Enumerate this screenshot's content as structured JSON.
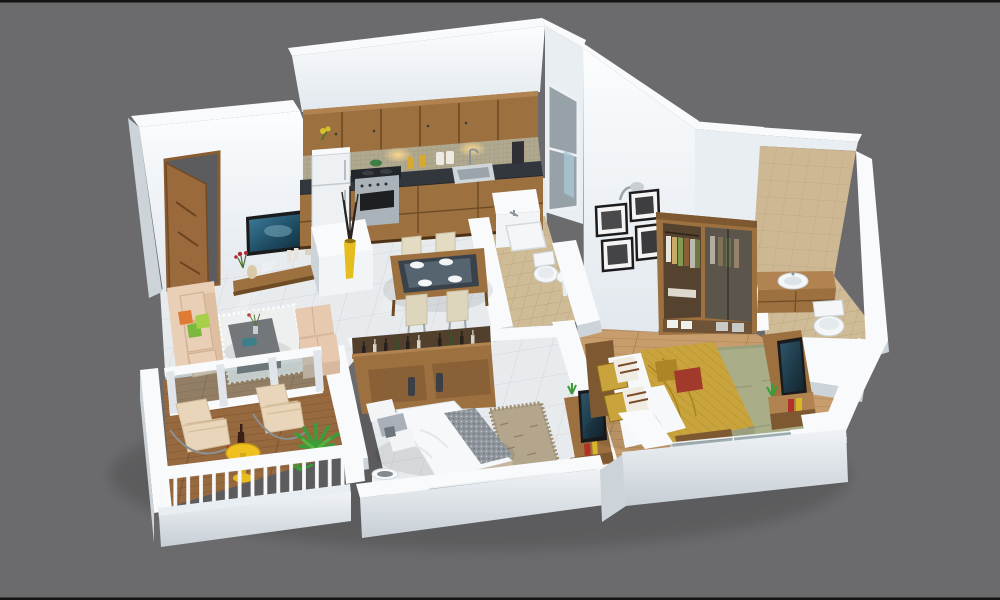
{
  "meta": {
    "description": "3D isometric render of a 2BHK apartment floor plan viewed from above on a plain gray background; no text labels are visible in the image",
    "image_type": "architectural-3d-floorplan"
  },
  "palette": {
    "bg": "#6b6b6d",
    "wallTop": "#f8fafc",
    "wallFace": "#e9eef2",
    "wallShade": "#ccd4da",
    "tileFloor": "#e8ebee",
    "tileLine": "#d0d5d9",
    "woodFloor": "#c79d6d",
    "woodLine": "#b08455",
    "deck": "#96693f",
    "deckLine": "#7a5230",
    "bathTile": "#cfbb95",
    "bathLine": "#b7a47e",
    "cabinet": "#9d7040",
    "cabinetDark": "#7e5830",
    "cabinetLight": "#b08350",
    "counter": "#32373d",
    "mosaic": "#b0a98f",
    "steel": "#aab3b9",
    "fridge": "#eef1f3",
    "door": "#9a6a3c",
    "tv": "#1a1b1d",
    "tvScreen": "#2e6f8f",
    "sofa": "#dfbfa2",
    "sofaLight": "#e9cfb5",
    "pillowOrange": "#e07b35",
    "pillowGreen": "#7cb83f",
    "pillowLime": "#a8cf4a",
    "coffeeTable": "#74777a",
    "rugWhite": "#eff1f1",
    "ottoman": "#e6c9ae",
    "vaseYellow": "#e6bd1f",
    "glass": "#9fb4bc",
    "bedWhite": "#f6f8f9",
    "bedGray": "#8f959c",
    "bedGold": "#c9a33c",
    "bedGoldDark": "#ab8526",
    "pillowRed": "#a23a2c",
    "rugSage": "#a9ad88",
    "rugShag": "#b3a68c",
    "plant": "#3c9c38",
    "toilet": "#f4f6f8",
    "tileWall": "#cdb893"
  },
  "rooms": [
    {
      "name": "living-room",
      "furniture": [
        "entrance-door",
        "wall-mounted-tv",
        "tv-shelf",
        "sofa",
        "cushions",
        "coffee-table",
        "white-rug",
        "ottoman-poufs",
        "yellow-floor-vase"
      ]
    },
    {
      "name": "kitchen",
      "furniture": [
        "upper-cabinets",
        "under-cabinet-lights",
        "mosaic-backsplash",
        "dark-countertop",
        "stove-oven",
        "sink",
        "refrigerator",
        "base-cabinets",
        "white-counter-blocks",
        "window"
      ]
    },
    {
      "name": "dining-area",
      "furniture": [
        "dining-table",
        "four-chairs",
        "plates"
      ]
    },
    {
      "name": "common-bathroom",
      "furniture": [
        "toilet",
        "washbasin",
        "shower-area",
        "half-walls"
      ]
    },
    {
      "name": "balcony",
      "furniture": [
        "wood-deck",
        "white-railing",
        "two-lounge-chairs",
        "yellow-drinks-table",
        "wine-bottle",
        "potted-plant",
        "glass-partition"
      ]
    },
    {
      "name": "bedroom-2",
      "furniture": [
        "storage-headboard-with-bottles",
        "double-bed-white",
        "gray-throw",
        "pillows",
        "laundry-basket",
        "shag-rug",
        "tv-unit",
        "window"
      ]
    },
    {
      "name": "master-bedroom",
      "furniture": [
        "open-wardrobe",
        "double-bed-gold",
        "accent-pillows",
        "sage-rug",
        "tv-unit",
        "picture-frames",
        "wall-lamp",
        "wood-floor",
        "window"
      ]
    },
    {
      "name": "master-bathroom",
      "furniture": [
        "vanity-washbasin",
        "toilet",
        "beige-tiled-wall"
      ]
    }
  ]
}
